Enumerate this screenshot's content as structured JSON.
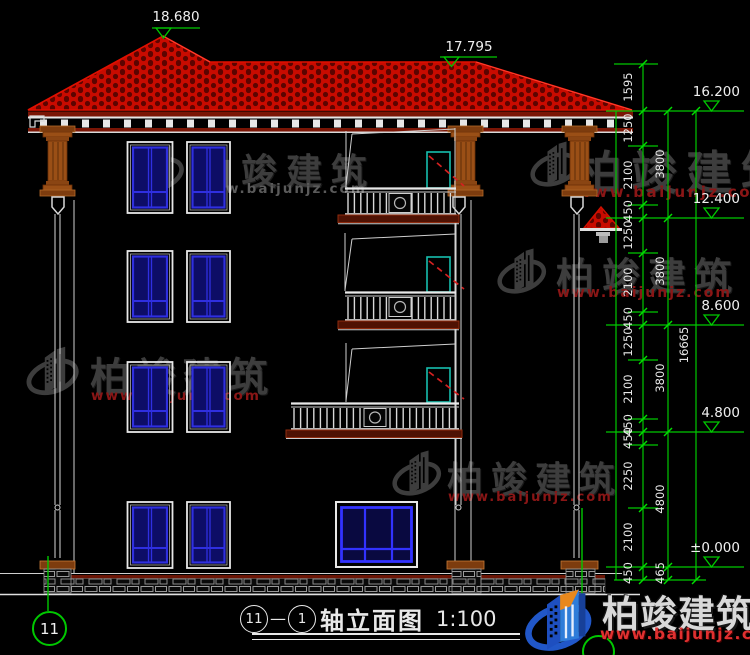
{
  "page": {
    "width": 750,
    "height": 655,
    "background": "#000000",
    "drawing_type": "建筑立面图 / building elevation CAD drawing"
  },
  "titleblock": {
    "axis_start": "11",
    "dash": "—",
    "axis_end": "1",
    "name": "轴立面图",
    "scale": "1:100"
  },
  "axis": {
    "left_bubble": "11"
  },
  "roof_markers": [
    {
      "value": "18.680"
    },
    {
      "value": "17.795"
    }
  ],
  "elevation_markers": [
    {
      "value": "16.200"
    },
    {
      "value": "12.400"
    },
    {
      "value": "8.600"
    },
    {
      "value": "4.800"
    },
    {
      "value": "±0.000"
    }
  ],
  "dims": {
    "chain": [
      "1595",
      "1250",
      "2100",
      "450",
      "1250",
      "2100",
      "450",
      "1250",
      "2100",
      "450",
      "450",
      "2250",
      "2100",
      "450"
    ],
    "blocks": [
      "3800",
      "3800",
      "3800",
      "4800",
      "465"
    ],
    "overall": "16665"
  },
  "watermark": {
    "brand": "柏竣建筑",
    "url": "www.baijunjz.com"
  },
  "footer": {
    "brand": "柏竣建筑",
    "url": "www.baijunjz.com"
  },
  "colors": {
    "roof_red": "#c80b00",
    "dim_green": "#00c800",
    "window_blue": "#2f2fe0",
    "door_teal": "#17bfae",
    "door_swing_red": "#d42020",
    "column_brown": "#9a4f16",
    "slab_red": "#4f1203",
    "watermark_gray": "#3d3d3d",
    "watermark_red": "#8a1616",
    "footer_blue": "#2157c8",
    "footer_orange": "#e8881c",
    "footer_red": "#e03030"
  }
}
